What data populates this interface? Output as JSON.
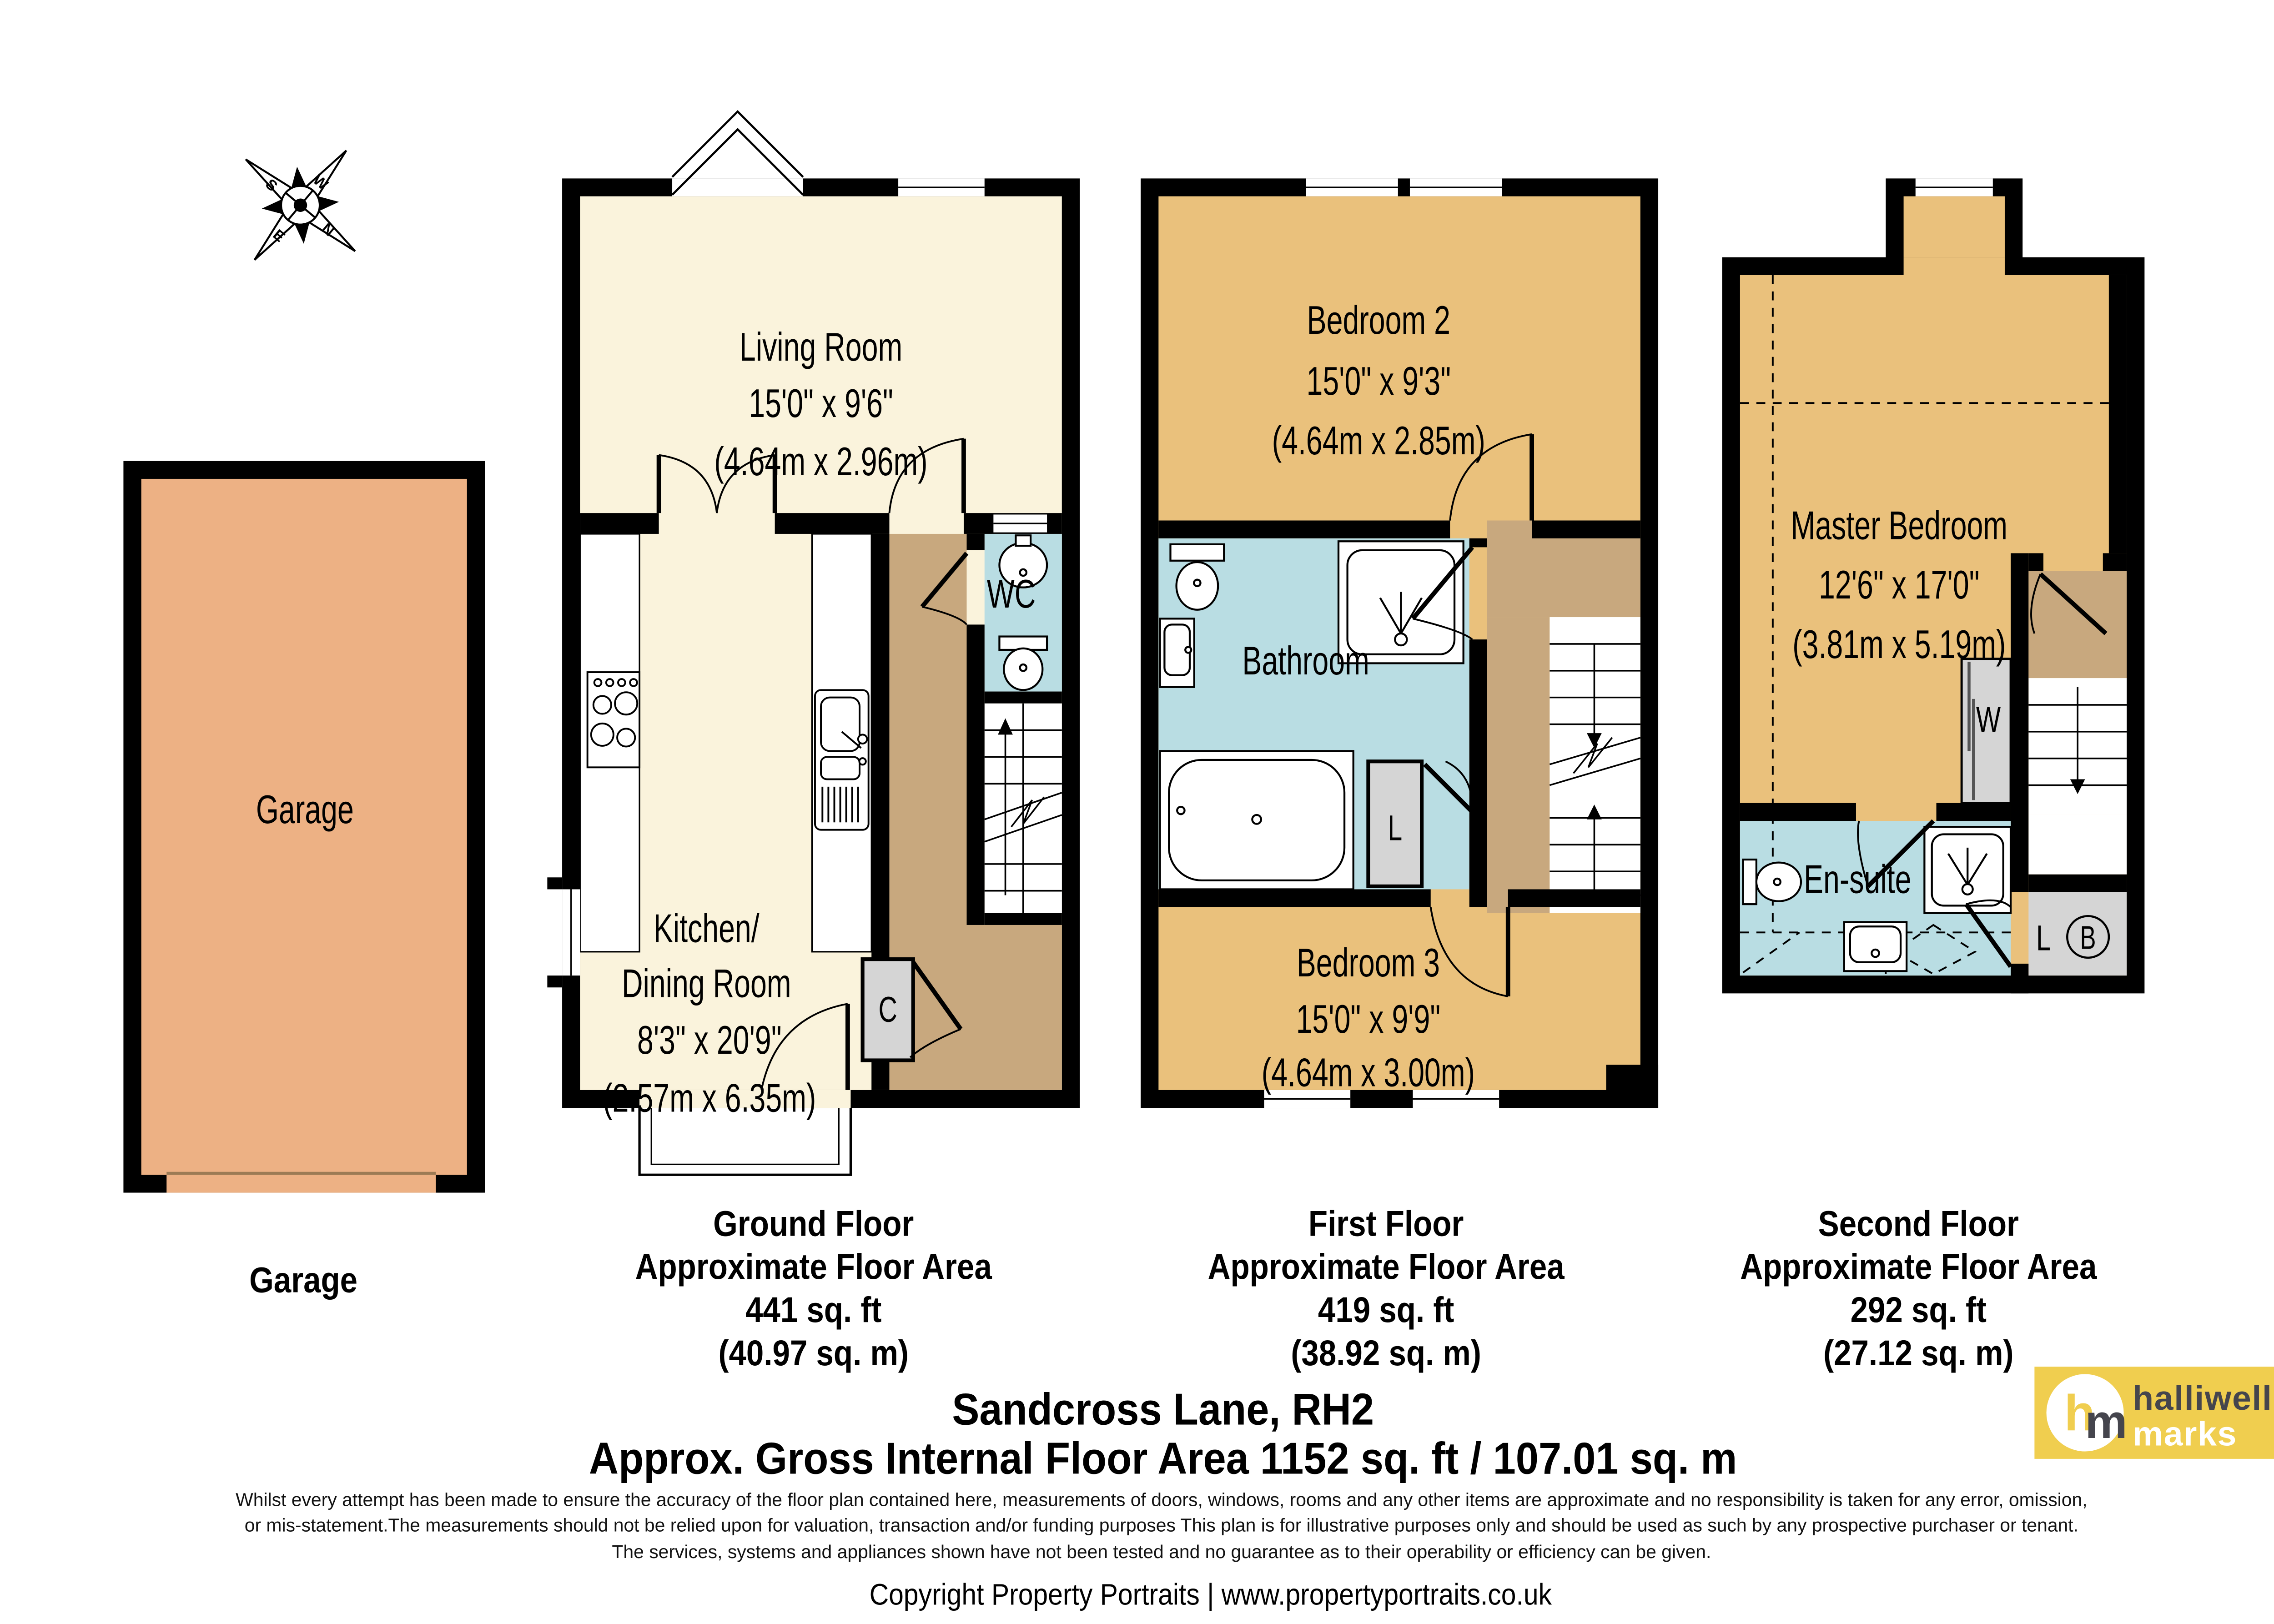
{
  "compass": {
    "n": "N",
    "s": "S",
    "e": "E",
    "w": "W"
  },
  "garage": {
    "room_label": "Garage",
    "caption": "Garage"
  },
  "ground_floor": {
    "living_room": [
      "Living Room",
      "15'0\" x 9'6\"",
      "(4.64m x 2.96m)"
    ],
    "kitchen": [
      "Kitchen/",
      "Dining Room",
      "8'3\" x 20'9\"",
      "(2.57m x 6.35m)"
    ],
    "wc": "WC",
    "cupboard": "C",
    "caption": [
      "Ground Floor",
      "Approximate Floor Area",
      "441 sq. ft",
      "(40.97 sq. m)"
    ]
  },
  "first_floor": {
    "bedroom2": [
      "Bedroom 2",
      "15'0\" x 9'3\"",
      "(4.64m x 2.85m)"
    ],
    "bathroom": "Bathroom",
    "cupboard": "L",
    "bedroom3": [
      "Bedroom 3",
      "15'0\" x 9'9\"",
      "(4.64m x 3.00m)"
    ],
    "caption": [
      "First Floor",
      "Approximate Floor Area",
      "419 sq. ft",
      "(38.92 sq. m)"
    ]
  },
  "second_floor": {
    "master": [
      "Master Bedroom",
      "12'6\" x 17'0\"",
      "(3.81m x 5.19m)"
    ],
    "ensuite": "En-suite",
    "wardrobe": "W",
    "cupboard": "L",
    "boiler": "B",
    "caption": [
      "Second Floor",
      "Approximate Floor Area",
      "292 sq. ft",
      "(27.12 sq. m)"
    ]
  },
  "footer": {
    "title_line1": "Sandcross Lane, RH2",
    "title_line2": "Approx. Gross Internal Floor Area 1152 sq. ft / 107.01 sq. m",
    "disclaimer": [
      "Whilst every attempt has been made to ensure the accuracy of the floor plan contained here, measurements of doors, windows, rooms and any other items are approximate and no responsibility is taken for any error, omission,",
      "or mis-statement.The measurements should not be relied upon for valuation, transaction and/or funding purposes This plan is for illustrative purposes only and should be used as such by any prospective purchaser or tenant.",
      "The services, systems and appliances shown have not been tested and no guarantee as to their operability or efficiency can be given."
    ],
    "copyright": "Copyright Property Portraits | www.propertyportraits.co.uk"
  },
  "logo": {
    "initial_h": "h",
    "initial_m": "m",
    "name_line1": "halliwell",
    "name_line2": "marks"
  },
  "colors": {
    "cream": "#FAF3DC",
    "golden": "#EAC17C",
    "salmon": "#EDB184",
    "hall_tan": "#C8A87E",
    "bath_blue": "#B9DDE3",
    "closet_grey": "#D5D5D5",
    "wall": "#000000",
    "logo_yellow": "#F0CE4F",
    "logo_dark": "#45454D"
  }
}
